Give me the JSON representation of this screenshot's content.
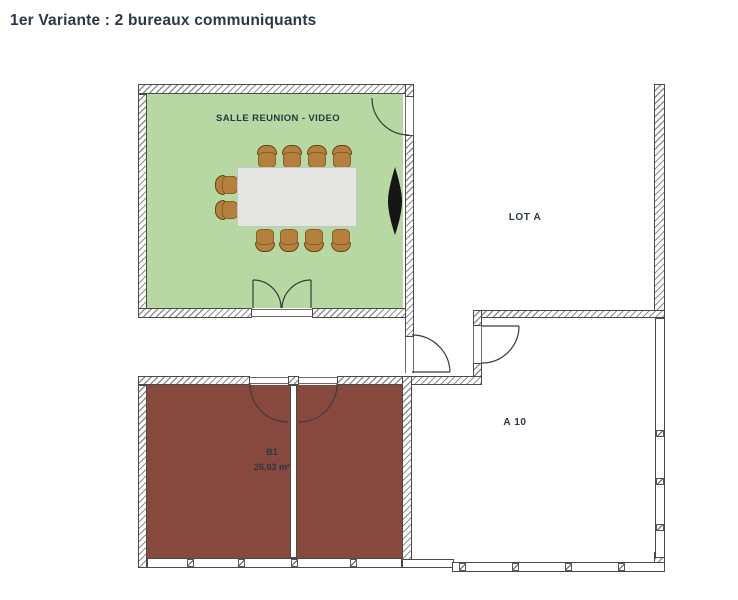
{
  "title": "1er Variante : 2 bureaux communiquants",
  "rooms": {
    "meeting": {
      "label": "SALLE REUNION - VIDEO"
    },
    "lot_a": {
      "label": "LOT A"
    },
    "a10": {
      "label": "A 10"
    },
    "b1": {
      "name": "B1",
      "area": "26,03 m²"
    }
  },
  "furniture": {
    "meeting_chair_count": 10,
    "meeting_table": "conference table",
    "wall_display": "video display"
  },
  "colors": {
    "meeting_fill": "#b7d8a3",
    "office_fill": "#87493e",
    "chair": "#b5803e",
    "table": "#e5e5e3",
    "line": "#4a4a4a",
    "text": "#2b3745"
  }
}
